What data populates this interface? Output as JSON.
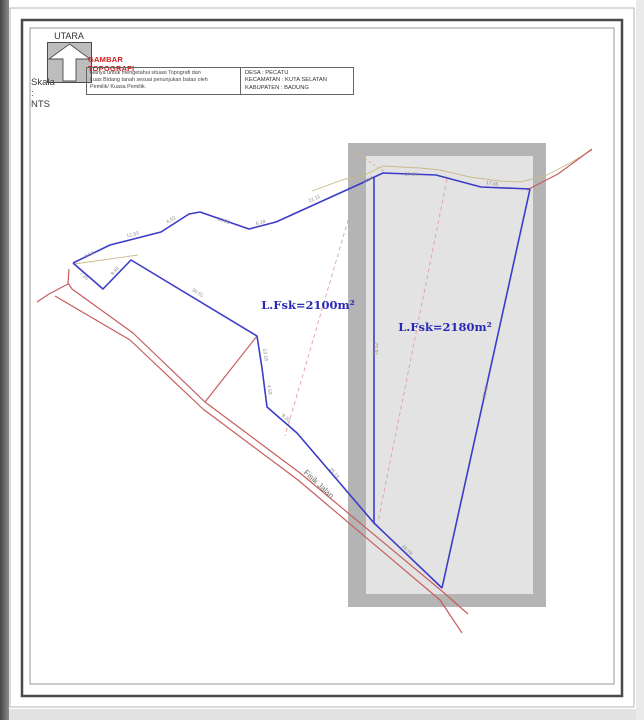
{
  "title_block": {
    "north_label": "UTARA",
    "north_icon": "north-arrow-in-square",
    "scale_label": "Skala : NTS",
    "title": "GAMBAR TOPOGRAFI",
    "description_lines": [
      "Hanya untuk mengetahui situasi Topografi dan",
      "Luas Bidang tanah sesuai penunjukan batas oleh",
      "Pemilik/ Kuasa Pemilik."
    ],
    "location_lines": [
      "DESA : PECATU",
      "KECAMATAN : KUTA SELATAN",
      "KABUPATEN : BADUNG"
    ]
  },
  "drawing": {
    "parcel_left_area": "L.Fsk=2100m²",
    "parcel_right_area": "L.Fsk=2180m²",
    "road_label": "Fisik Jalan",
    "svg_labels": [
      {
        "text": "L.Fsk=2100m²",
        "x": 308,
        "y": 309,
        "angle": 0,
        "cls": "area"
      },
      {
        "text": "L.Fsk=2180m²",
        "x": 445,
        "y": 331,
        "angle": 0,
        "cls": "area"
      },
      {
        "text": "Fisik Jalan",
        "x": 317,
        "y": 486,
        "angle": 43,
        "cls": "road"
      },
      {
        "text": "0.64",
        "x": 90,
        "y": 256,
        "angle": -26,
        "cls": "measure"
      },
      {
        "text": "7.25",
        "x": 83,
        "y": 277,
        "angle": 41,
        "cls": "measure"
      },
      {
        "text": "9.45",
        "x": 116,
        "y": 272,
        "angle": -46,
        "cls": "measure"
      },
      {
        "text": "12.93",
        "x": 133,
        "y": 236,
        "angle": -14,
        "cls": "measure"
      },
      {
        "text": "6.52",
        "x": 172,
        "y": 221,
        "angle": -33,
        "cls": "measure"
      },
      {
        "text": "13.00",
        "x": 223,
        "y": 222,
        "angle": 19,
        "cls": "measure"
      },
      {
        "text": "6.18",
        "x": 261,
        "y": 224,
        "angle": -15,
        "cls": "measure"
      },
      {
        "text": "21.11",
        "x": 315,
        "y": 200,
        "angle": -24,
        "cls": "measure"
      },
      {
        "text": "4.54",
        "x": 369,
        "y": 181,
        "angle": -25,
        "cls": "measure"
      },
      {
        "text": "17.59",
        "x": 411,
        "y": 176,
        "angle": 2,
        "cls": "measure"
      },
      {
        "text": "17.45",
        "x": 492,
        "y": 185,
        "angle": 10,
        "cls": "measure"
      },
      {
        "text": "30.51",
        "x": 197,
        "y": 294,
        "angle": 31,
        "cls": "measure"
      },
      {
        "text": "13.18",
        "x": 264,
        "y": 355,
        "angle": 81,
        "cls": "measure"
      },
      {
        "text": "4.59",
        "x": 268,
        "y": 390,
        "angle": 83,
        "cls": "measure"
      },
      {
        "text": "9.20",
        "x": 285,
        "y": 419,
        "angle": 41,
        "cls": "measure"
      },
      {
        "text": "25.73",
        "x": 333,
        "y": 474,
        "angle": 49,
        "cls": "measure"
      },
      {
        "text": "20.19",
        "x": 406,
        "y": 551,
        "angle": 44,
        "cls": "measure"
      },
      {
        "text": "78.12",
        "x": 378,
        "y": 349,
        "angle": -90,
        "cls": "measure"
      },
      {
        "text": "97.48",
        "x": 487,
        "y": 392,
        "angle": -78,
        "cls": "measure"
      }
    ],
    "colors": {
      "parcel_line": "#3c3cc8",
      "road_line": "#c75d5d",
      "dashed_line": "#e0a2a2",
      "terrain_line": "#cbb98a",
      "area_text": "#2929b8",
      "title_red": "#cc2222",
      "measure_text": "#8c8c8c"
    }
  }
}
